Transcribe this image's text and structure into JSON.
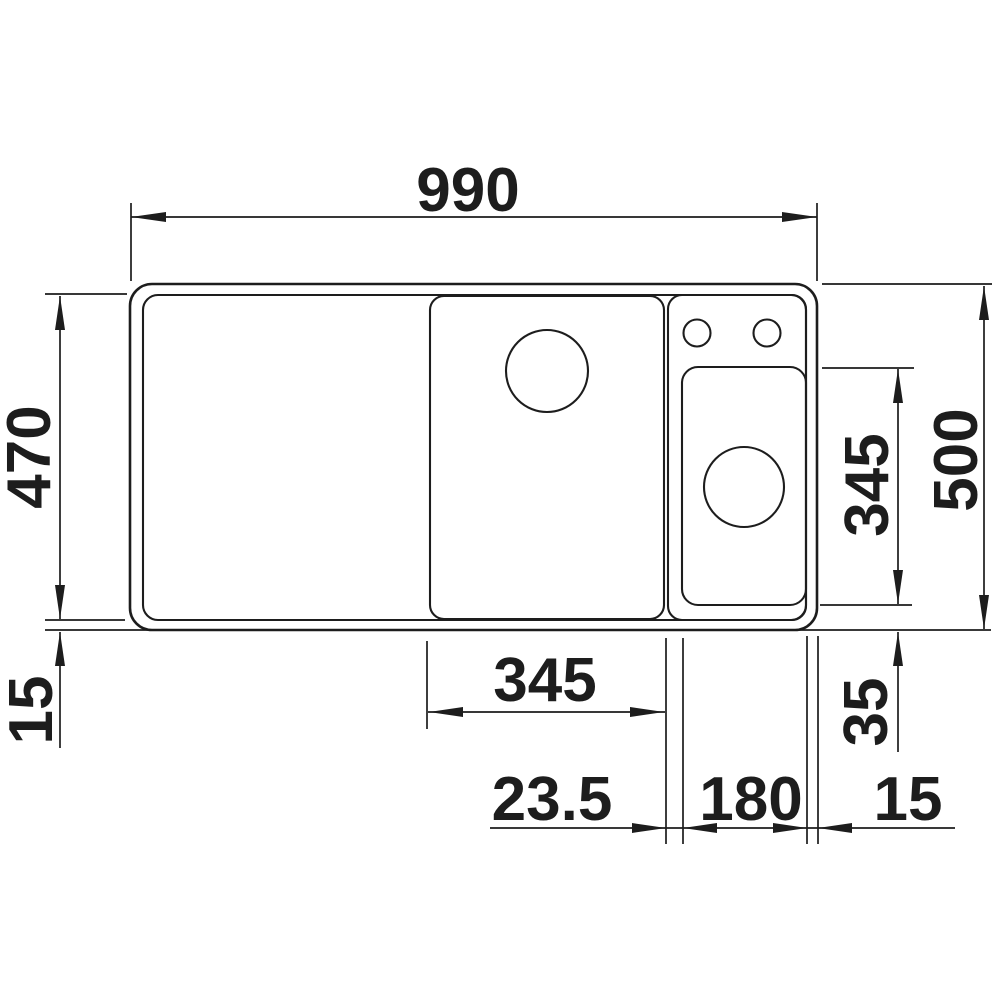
{
  "drawing": {
    "type": "sink-technical-dimension-drawing",
    "unit_system": "millimetres (implied, not printed)",
    "ink_color": "#1d1d1d",
    "background_color": "#ffffff"
  },
  "dimensions": {
    "overall_width": "990",
    "basin_area_height": "470",
    "rim_left": "15",
    "overall_height": "500",
    "accessory_bowl_height": "345",
    "accessory_bowl_bottom_offset": "35",
    "main_bowl_width": "345",
    "bowl_gap": "23.5",
    "accessory_bowl_width": "180",
    "rim_right": "15"
  }
}
